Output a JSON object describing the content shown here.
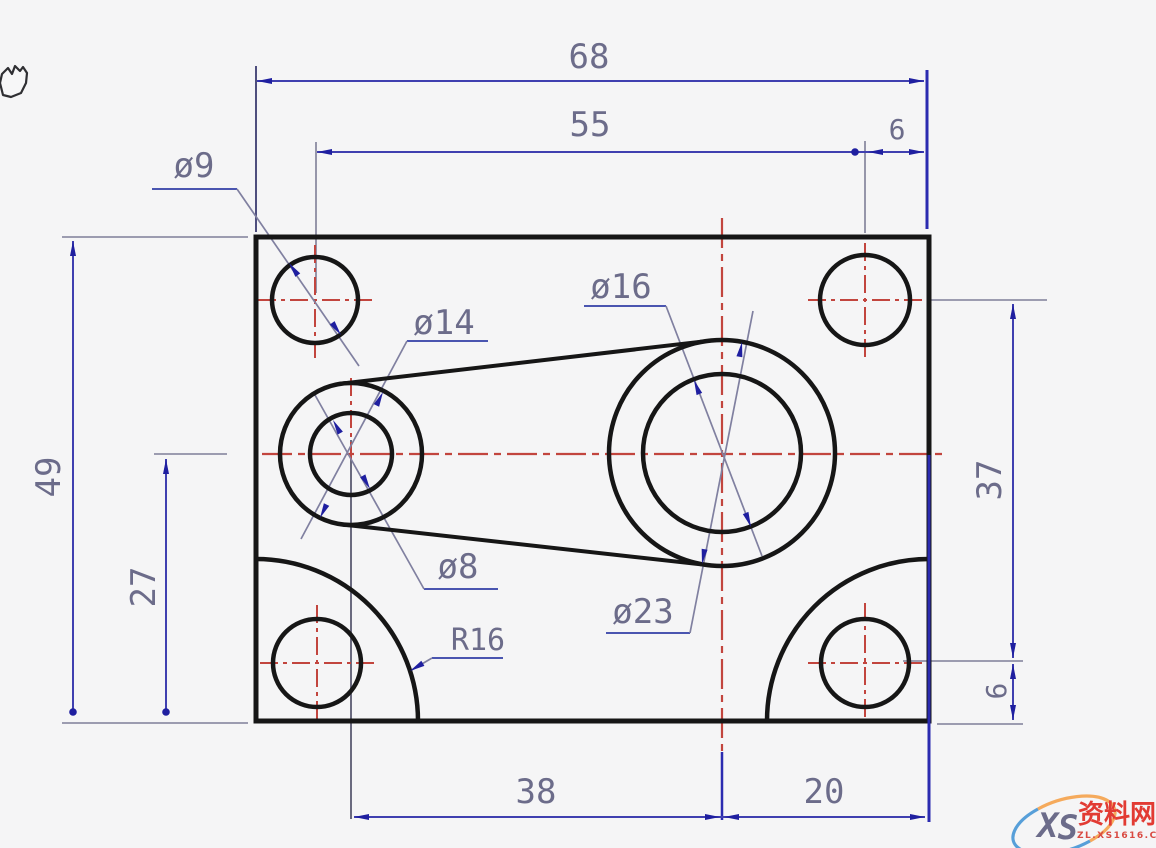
{
  "viewer": {
    "cursor": "pan-hand"
  },
  "drawing": {
    "dim_labels": {
      "total_width": "68",
      "hole_span_x": "55",
      "edge_offset_top_right": "6",
      "total_height": "49",
      "axis_from_bottom": "27",
      "hole_span_y": "37",
      "edge_offset_bottom_right": "6",
      "axis_span_x": "38",
      "axis_to_right_edge": "20"
    },
    "feature_labels": {
      "corner_hole_dia": "ø9",
      "boss_outer_dia": "ø14",
      "boss_hole_dia": "ø8",
      "hub_hole_dia": "ø16",
      "hub_outer_dia": "ø23",
      "corner_fillet_radius": "R16"
    },
    "colors": {
      "geometry": "#161616",
      "centerline_red": "#c2453e",
      "dim_line_navy": "#4040b0",
      "extension_gray": "#7e7e98",
      "arrow_navy": "#1f1fa0",
      "dim_text": "#6c6c8a",
      "background": "#f5f5f6"
    }
  },
  "watermark": {
    "logo_text_x": "X",
    "logo_text_s": "S",
    "site_name": "资料网",
    "site_url": "ZL.XS1616.COM",
    "swoosh_blue": "#3b8fd4",
    "swoosh_orange": "#f5a24b",
    "logo_x_color": "#7a93b5",
    "logo_s_color": "#e05a6a",
    "text_red": "#e23b33"
  }
}
